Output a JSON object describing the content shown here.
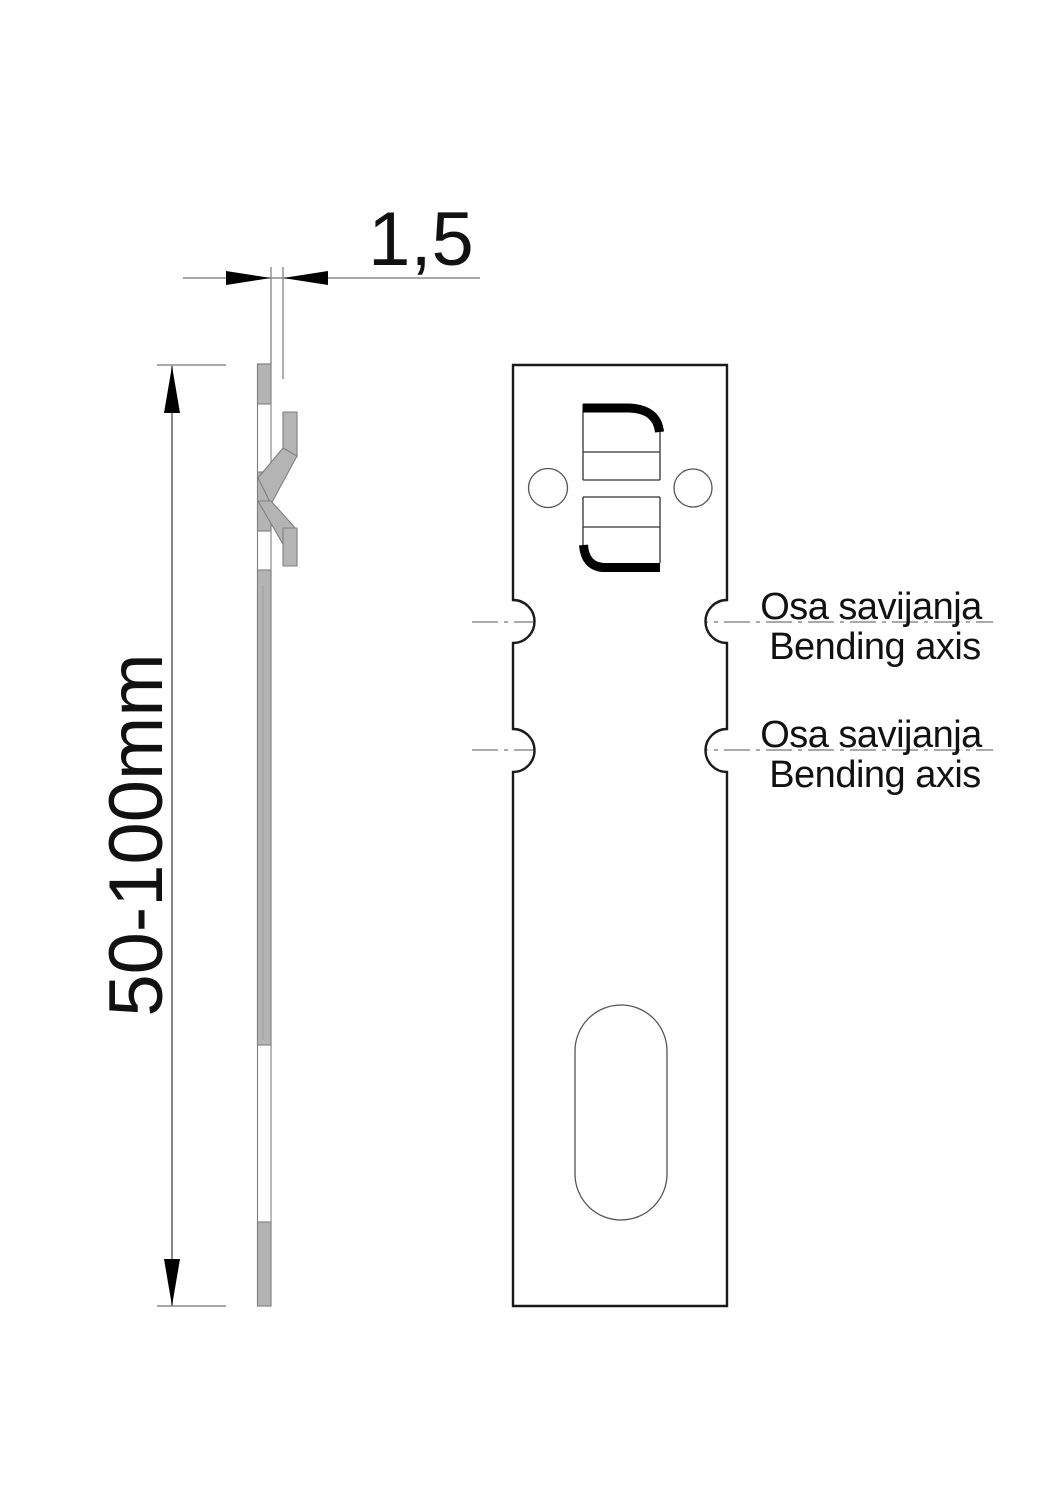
{
  "drawing": {
    "type": "technical-drawing",
    "part": "sheet-metal bending anchor, side profile and front face views"
  },
  "dimensions": {
    "thickness": "1,5",
    "height_range": "50-100mm"
  },
  "annotations": {
    "bending_axis_1": {
      "local": "Osa savijanja",
      "english": "Bending axis"
    },
    "bending_axis_2": {
      "local": "Osa savijanja",
      "english": "Bending axis"
    }
  },
  "colors": {
    "background": "#ffffff",
    "outline": "#1a1a1a",
    "metal_fill": "#b4b4b4",
    "metal_edge": "#7f7f7f",
    "dimension_line": "#8c8c8c",
    "axis_line": "#777777",
    "text": "#111111"
  }
}
